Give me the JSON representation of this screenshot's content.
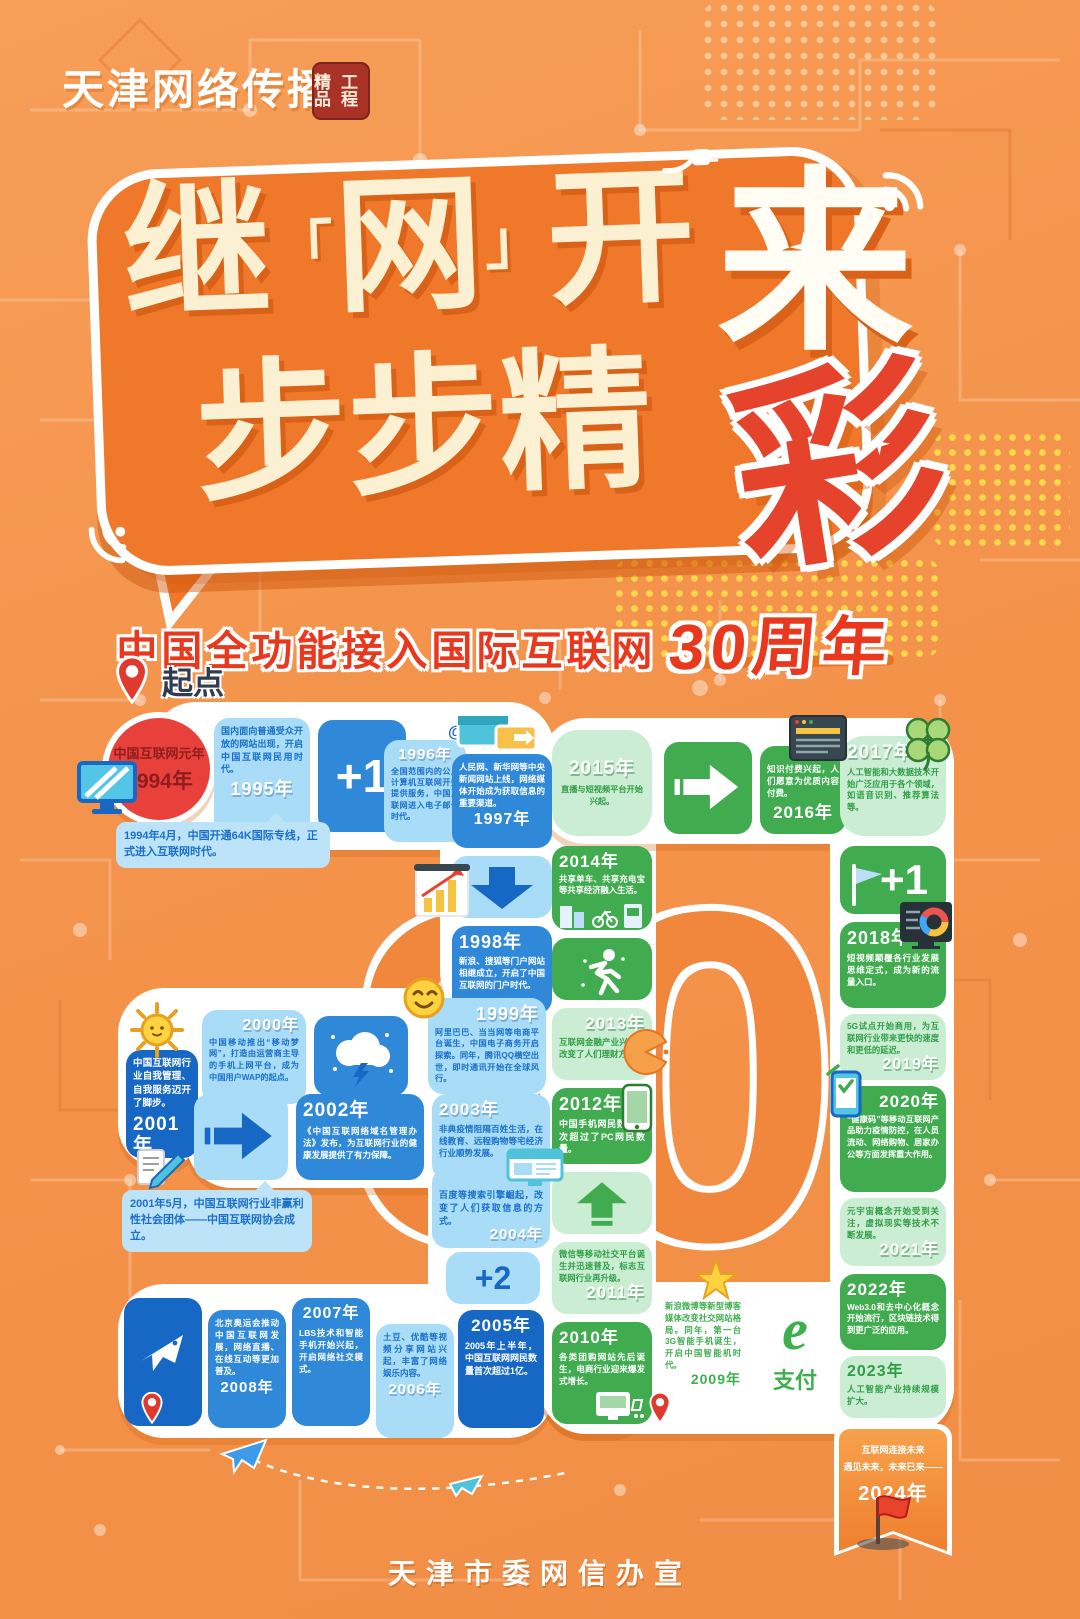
{
  "header": {
    "logo": "天津网络传播",
    "seal1": "精品",
    "seal2": "工程"
  },
  "title": {
    "c1": "继",
    "q1": "「",
    "net": "网",
    "q2": "」",
    "c3": "开",
    "lai": "来",
    "l2": "步步精",
    "cai": "彩"
  },
  "subtitle": {
    "text": "中国全功能接入国际互联网",
    "em": "30周年"
  },
  "watermark": "30",
  "start": {
    "label": "起点"
  },
  "footer": {
    "text": "天津市委网信办宣"
  },
  "palette": {
    "background": "#F4934B",
    "bubble": "#F0782A",
    "cream": "#FCF0D2",
    "red": "#E8432C",
    "blue": "#2F88D8",
    "dark_blue": "#1768C5",
    "light_blue": "#A9DCF7",
    "green": "#41AC4F",
    "light_green": "#CBEDD3",
    "path_white": "#FFFFFF",
    "ribbon_orange": "#EE8030"
  },
  "icons": {
    "start-pin": "📍",
    "wifi": "📶",
    "sparkle": "✦",
    "at-sign": "@",
    "monitor": "🖥",
    "browser-windows": "🗔",
    "down-arrow": "⬇",
    "bar-chart": "📊",
    "smiley": "😊",
    "storm-cloud": "⛈",
    "sun": "🌞",
    "pencil-doc": "📝",
    "right-arrow": "➡",
    "up-arrow": "⬆",
    "plane": "✈",
    "runner": "🏃",
    "pie": "◔",
    "phone": "📱",
    "star": "⭐",
    "clover": "🍀",
    "flag": "🚩",
    "donut-chart": "◍",
    "phone-check": "✅",
    "finish-flag": "⛳"
  },
  "tl": {
    "y1994": {
      "title": "中国互联网元年",
      "year": "1994年",
      "note": "1994年4月，中国开通64K国际专线，正式进入互联网时代。"
    },
    "y1995": {
      "text": "国内面向普通受众开放的网站出现，开启中国互联网民用时代。",
      "year": "1995年"
    },
    "plus1": {
      "label": "+1"
    },
    "y1996": {
      "year": "1996年",
      "at": "@",
      "text": "全国范围内的公用计算机互联网开始提供服务，中国互联网进入电子邮件时代。"
    },
    "y1997": {
      "text": "人民网、新华网等中央新闻网站上线，网络媒体开始成为获取信息的重要渠道。",
      "year": "1997年"
    },
    "y1998": {
      "year": "1998年",
      "text": "新浪、搜狐等门户网站相继成立，开启了中国互联网的门户时代。"
    },
    "y1999": {
      "year": "1999年",
      "text": "阿里巴巴、当当网等电商平台诞生，中国电子商务开启探索。同年，腾讯QQ横空出世，即时通讯开始在全球风行。"
    },
    "y2000": {
      "year": "2000年",
      "text": "中国移动推出“移动梦网”，打造由运营商主导的手机上网平台，成为中国用户WAP的起点。"
    },
    "y2001": {
      "text": "中国互联网行业自我管理、自我服务迈开了脚步。",
      "year": "2001年",
      "note": "2001年5月，中国互联网行业非赢利性社会团体——中国互联网协会成立。"
    },
    "y2002": {
      "year": "2002年",
      "text": "《中国互联网络域名管理办法》发布，为互联网行业的健康发展提供了有力保障。"
    },
    "y2003": {
      "year": "2003年",
      "text": "非典疫情阻隔百姓生活，在线教育、远程购物等宅经济行业顺势发展。"
    },
    "y2004": {
      "text": "百度等搜索引擎崛起，改变了人们获取信息的方式。",
      "year": "2004年"
    },
    "plus2": {
      "label": "+2"
    },
    "y2005": {
      "year": "2005年",
      "text": "2005年上半年，中国互联网网民数量首次超过1亿。"
    },
    "y2006": {
      "text": "土豆、优酷等视频分享网站兴起，丰富了网络娱乐内容。",
      "year": "2006年"
    },
    "y2007": {
      "year": "2007年",
      "text": "LBS技术和智能手机开始兴起，开启网络社交模式。"
    },
    "y2008": {
      "text": "北京奥运会推动中国互联网发展，网络直播、在线互动等更加普及。",
      "year": "2008年"
    },
    "y2009": {
      "text": "新浪微博等新型博客媒体改变社交网站格局。同年，第一台3G智能手机诞生，开启中国智能机时代。",
      "year": "2009年"
    },
    "epay": {
      "e": "e",
      "label": "支付"
    },
    "y2010": {
      "year": "2010年",
      "text": "各类团购网站先后诞生，电商行业迎来爆发式增长。"
    },
    "y2011": {
      "text": "微信等移动社交平台诞生并迅速普及，标志互联网行业再升级。",
      "year": "2011年"
    },
    "y2012": {
      "year": "2012年",
      "text": "中国手机网民数量首次超过了PC网民数量。"
    },
    "y2013": {
      "year": "2013年",
      "text": "互联网金融产业兴起，改变了人们理财方式。"
    },
    "y2014": {
      "year": "2014年",
      "text": "共享单车、共享充电宝等共享经济融入生活。"
    },
    "y2015": {
      "year": "2015年",
      "text": "直播与短视频平台开始兴起。"
    },
    "plus1g": {
      "label": "+1"
    },
    "y2016": {
      "text": "知识付费兴起，人们愿意为优质内容付费。",
      "year": "2016年"
    },
    "y2017": {
      "year": "2017年",
      "text": "人工智能和大数据技术开始广泛应用于各个领域，如语音识别、推荐算法等。"
    },
    "y2018": {
      "year": "2018年",
      "text": "短视频颠覆各行业发展思维定式，成为新的流量入口。"
    },
    "y2019": {
      "text": "5G试点开始商用，为互联网行业带来更快的速度和更低的延迟。",
      "year": "2019年"
    },
    "y2020": {
      "year": "2020年",
      "text": "“健康码”等移动互联网产品助力疫情防控，在人员流动、网络购物、居家办公等方面发挥重大作用。"
    },
    "y2021": {
      "text": "元宇宙概念开始受到关注，虚拟现实等技术不断发展。",
      "year": "2021年"
    },
    "y2022": {
      "year": "2022年",
      "text": "Web3.0和去中心化概念开始流行，区块链技术得到更广泛的应用。"
    },
    "y2023": {
      "year": "2023年",
      "text": "人工智能产业持续规模扩大。"
    },
    "y2024": {
      "text1": "互联网连接未来",
      "text2": "遇见未来，未来已来——",
      "year": "2024年"
    }
  }
}
